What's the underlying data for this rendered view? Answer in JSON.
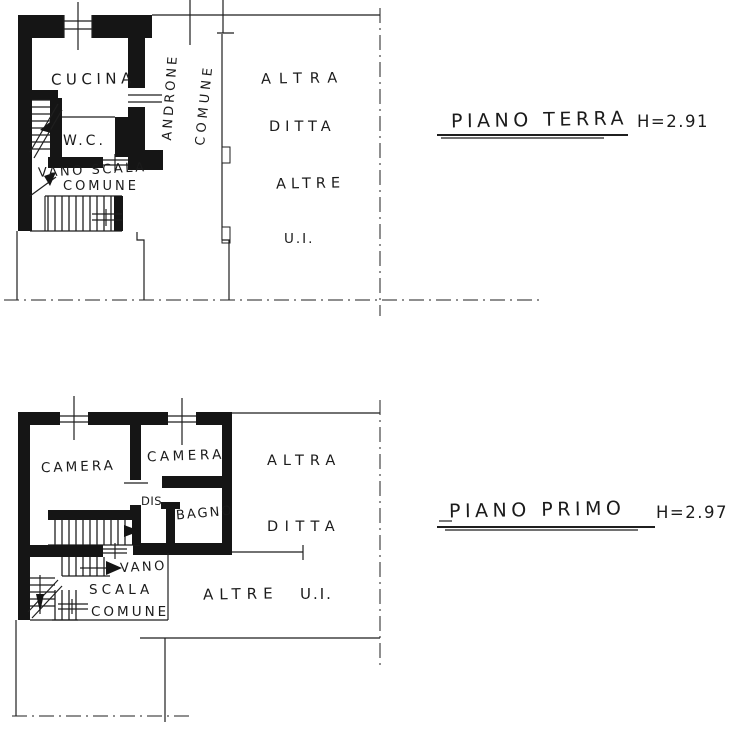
{
  "document": {
    "type": "floor-plan-scan",
    "paper_color": "#ffffff",
    "ink_color": "#1b1b1b"
  },
  "floors": {
    "terra": {
      "title": "PIANO TERRA",
      "height": "H=2.91",
      "labels": {
        "cucina": "CUCINA",
        "wc": "W.C.",
        "vano_scala_1": "VANO SCALA",
        "vano_scala_2": "COMUNE",
        "androne": "ANDRONE",
        "androne_comune": "COMUNE",
        "altra": "ALTRA",
        "ditta": "DITTA",
        "altre": "ALTRE",
        "ui": "U.I."
      }
    },
    "primo": {
      "title": "PIANO PRIMO",
      "height": "H=2.97",
      "labels": {
        "camera_1": "CAMERA",
        "camera_2": "CAMERA",
        "dis": "DIS.",
        "bagno": "BAGNO",
        "vano": "VANO",
        "scala": "SCALA",
        "comune": "COMUNE",
        "altra": "ALTRA",
        "ditta": "DITTA",
        "altre": "ALTRE",
        "ui": "U.I."
      }
    }
  }
}
